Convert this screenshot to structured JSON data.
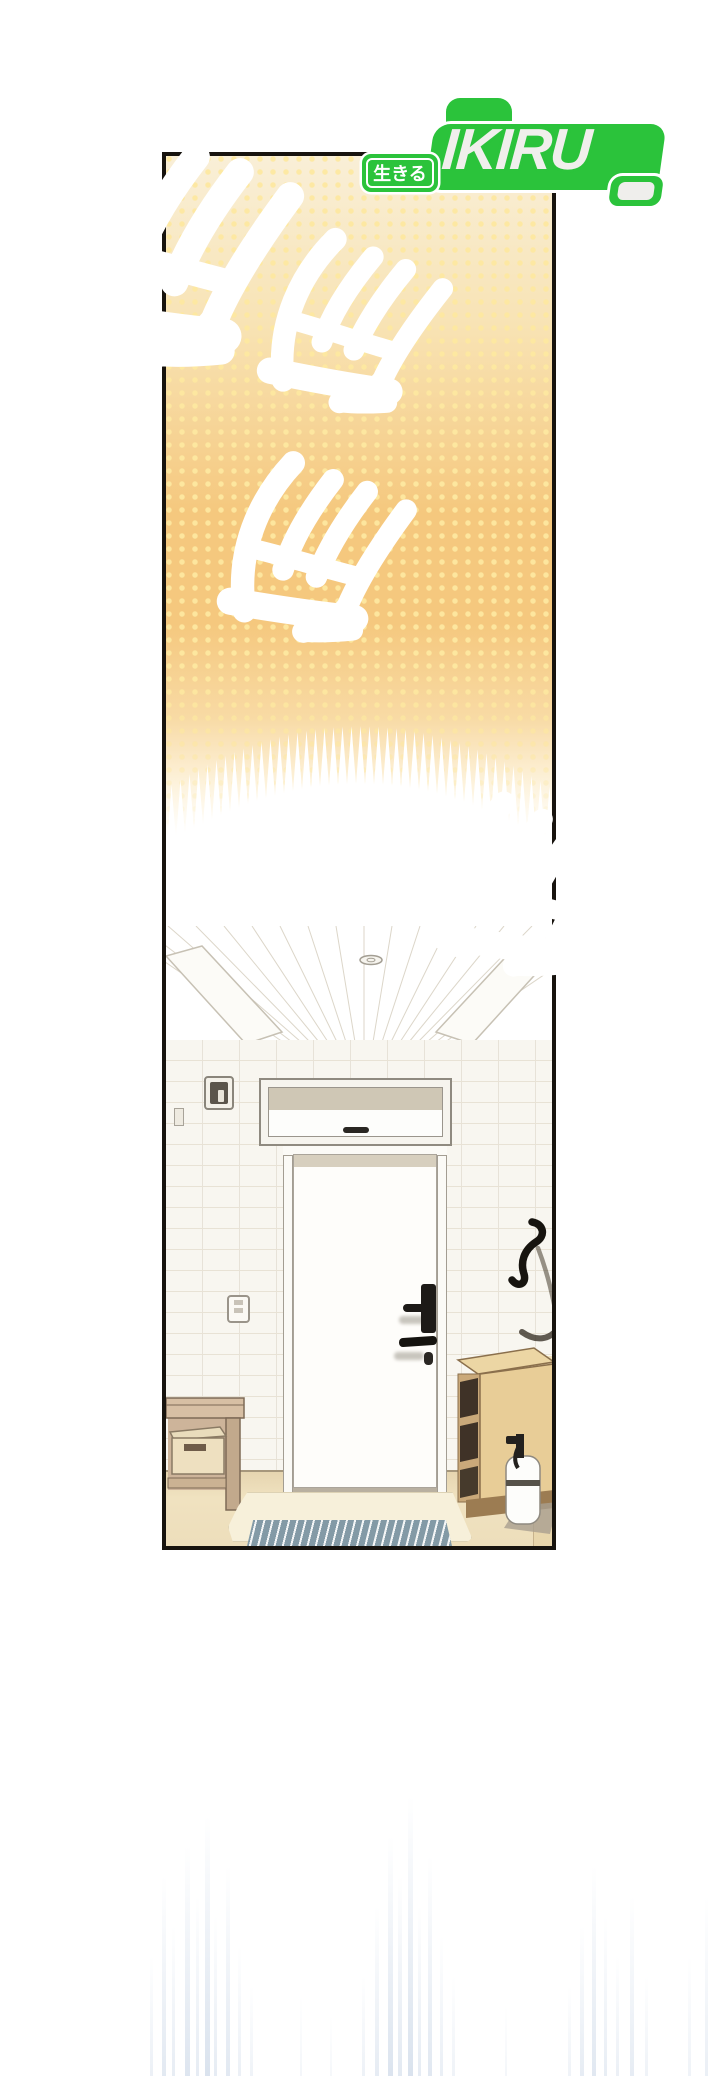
{
  "page": {
    "width": 720,
    "height": 2076,
    "background": "#ffffff"
  },
  "logo": {
    "brand": "IKIRU",
    "badge": "生きる",
    "green": "#2bc33b",
    "letter_color": "#f0efec"
  },
  "sfx": {
    "glyph": "삐",
    "count": 4,
    "full_text": "삐삐삐삐",
    "outline": "#ffffff",
    "gradient_top": "#c28a3c",
    "gradient_bottom": "#0b0602"
  },
  "panel": {
    "border_color": "#17130e",
    "halftone_top": "#f9efd7",
    "halftone_orange": "#f5c87e",
    "halftone_dot": "#fde8a0"
  },
  "scene": {
    "objects": [
      "ceiling-light",
      "ceiling-beams",
      "transom-window",
      "doorbell",
      "front-door",
      "door-lock",
      "light-switch",
      "shoehorn",
      "shoe-cabinet",
      "bench",
      "storage-box",
      "entry-mat",
      "striped-doormat",
      "spray-bottle"
    ]
  },
  "footer_effect": {
    "streak_color": "#a6bbd6"
  }
}
